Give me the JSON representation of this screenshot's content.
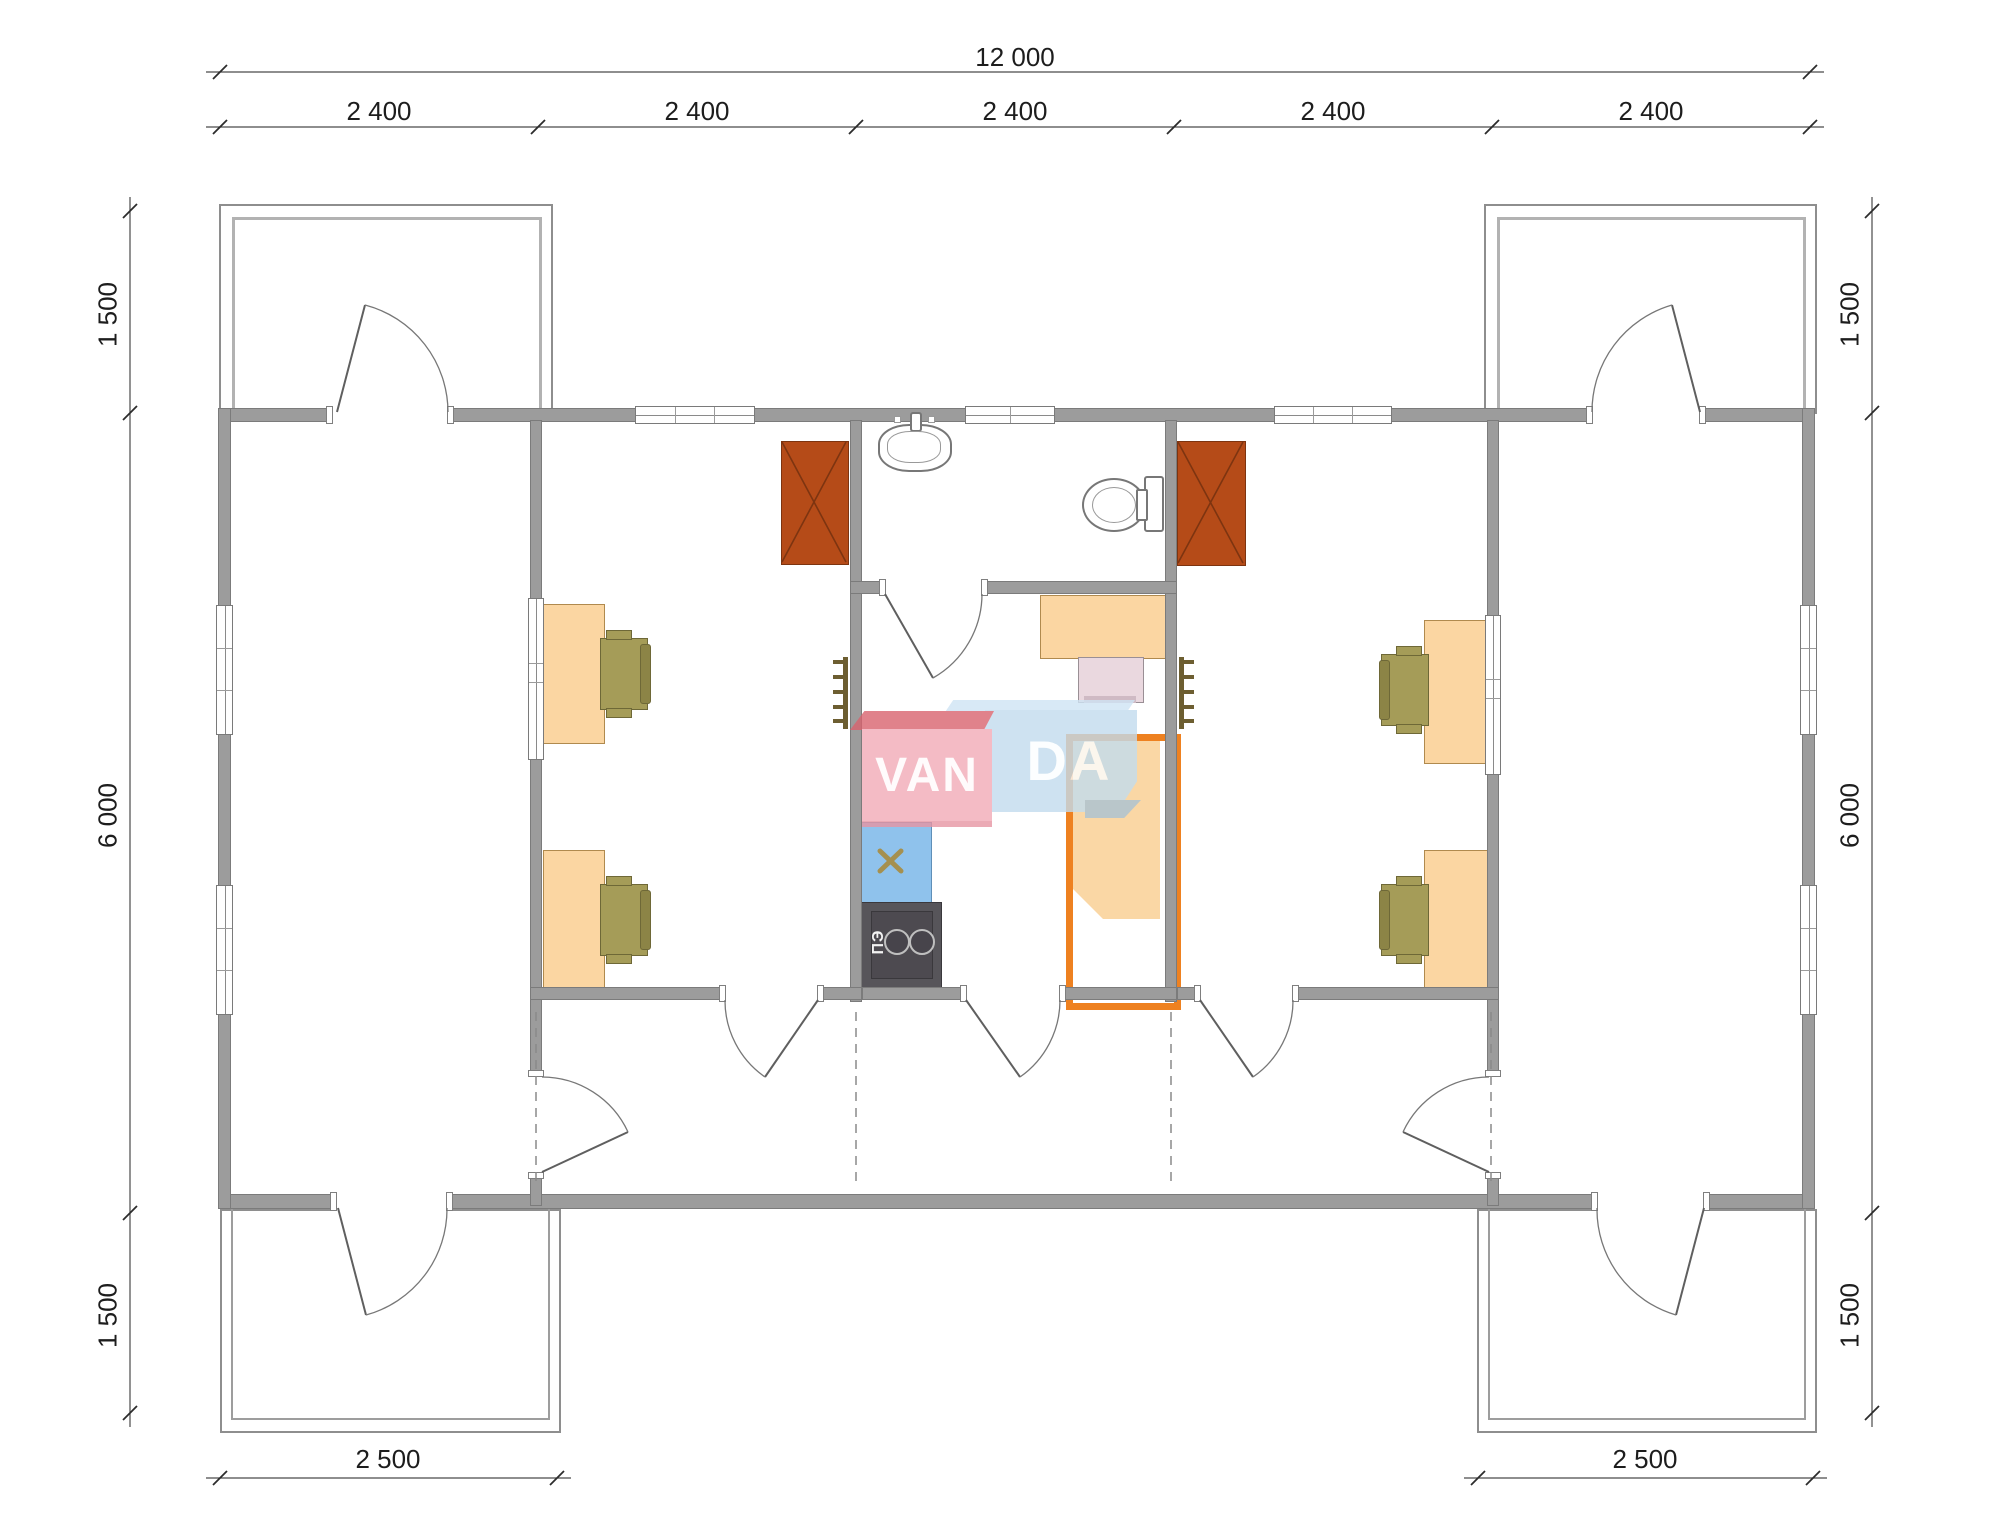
{
  "plan": {
    "type": "floor-plan",
    "brand_watermark": "VANDA",
    "logo": {
      "part1": "VAN",
      "part2": "DA"
    },
    "stove_label": "ПЭ",
    "dimensions": {
      "top_total": "12 000",
      "top_segments": [
        "2 400",
        "2 400",
        "2 400",
        "2 400",
        "2 400"
      ],
      "left": [
        "1 500",
        "6 000",
        "1 500"
      ],
      "right": [
        "1 500",
        "6 000",
        "1 500"
      ],
      "bottom_left": "2 500",
      "bottom_right": "2 500"
    },
    "colors": {
      "wall": "#9c9c9c",
      "wardrobe": "#b54b18",
      "desk": "#fbd6a2",
      "chair": "#a59c58",
      "bed_frame": "#ee8120",
      "blanket": "#fad7a5",
      "kitchen_counter": "#8fc2ec",
      "stove": "#57555a",
      "heater": "#6d5e31",
      "logo_pink": "#f2abb7",
      "logo_pink_dark": "#d9636f",
      "logo_blue": "#c3dcee",
      "logo_blue_light": "#cfe4f4"
    },
    "furniture_icons": [
      "desk",
      "office-chair",
      "wardrobe",
      "bed",
      "sink",
      "toilet",
      "kitchen-sink-counter",
      "electric-stove",
      "wall-heater",
      "kitchen-table",
      "pink-chair"
    ]
  }
}
